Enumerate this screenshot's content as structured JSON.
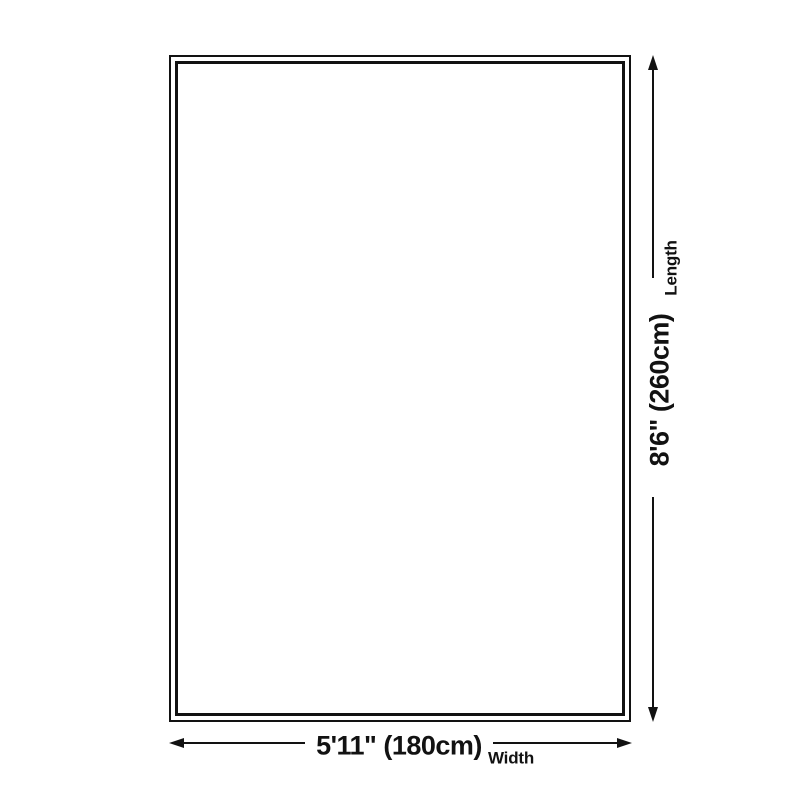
{
  "diagram": {
    "type": "product-size-diagram",
    "background_color": "#ffffff",
    "line_color": "#121212",
    "rug": {
      "shape": "rectangle",
      "border_style": "double"
    },
    "length": {
      "value": "8'6\" (260cm)",
      "label": "Length"
    },
    "width": {
      "value": "5'11\" (180cm)",
      "label": "Width"
    }
  }
}
